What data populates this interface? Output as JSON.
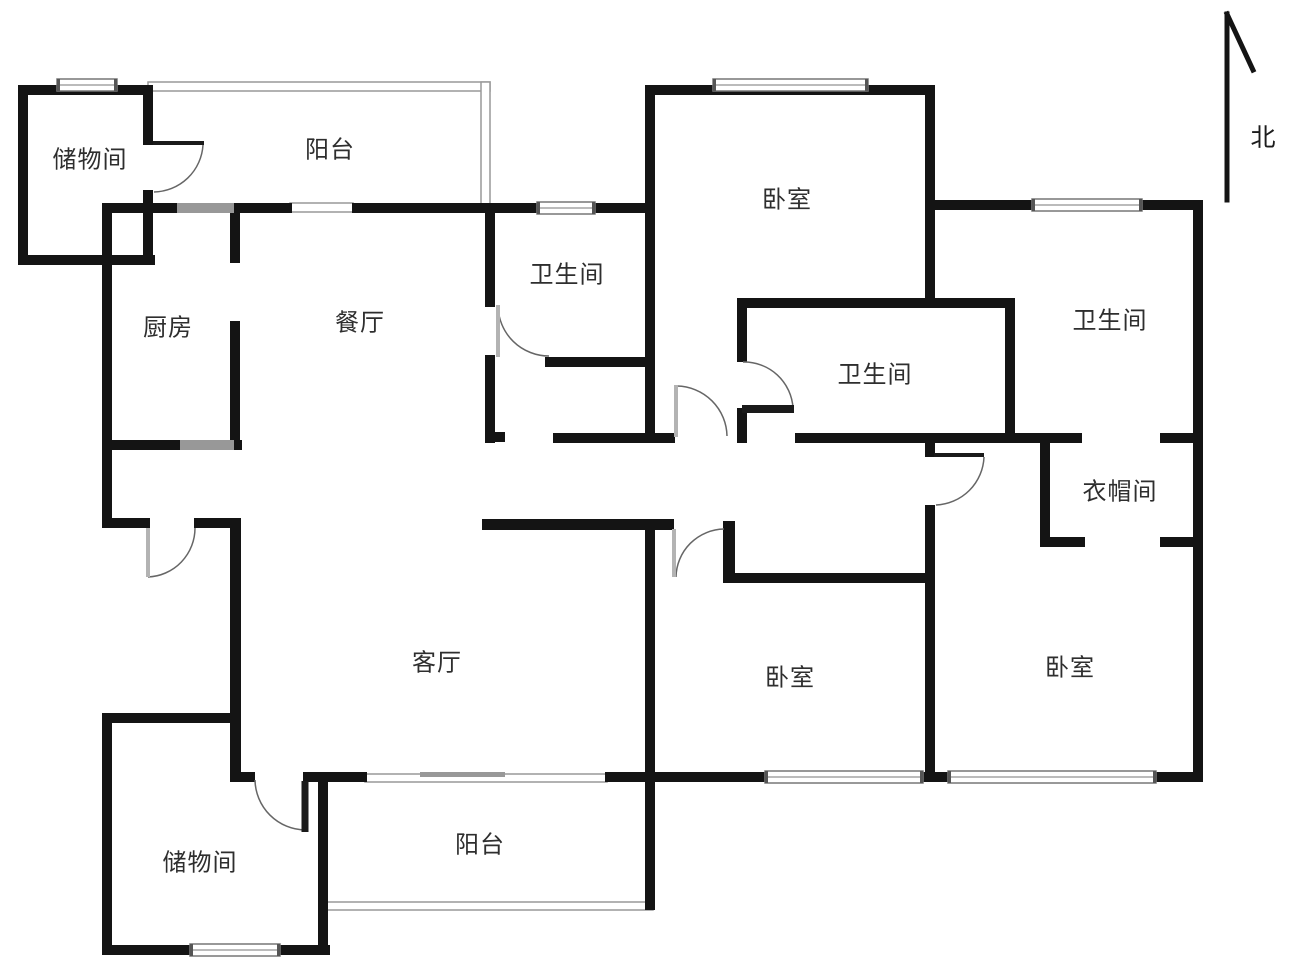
{
  "north": {
    "label": "北",
    "x": 1263,
    "y": 136,
    "lines": [
      [
        1227,
        14,
        1227,
        200
      ],
      [
        1227,
        14,
        1253,
        70
      ]
    ],
    "stroke_width": 5
  },
  "rooms": {
    "storage_top": {
      "label": "储物间",
      "x": 90,
      "y": 157
    },
    "balcony_top": {
      "label": "阳台",
      "x": 330,
      "y": 147
    },
    "bedroom_north": {
      "label": "卧室",
      "x": 787,
      "y": 197
    },
    "bath_north": {
      "label": "卫生间",
      "x": 567,
      "y": 272
    },
    "bath_east": {
      "label": "卫生间",
      "x": 1110,
      "y": 318
    },
    "kitchen": {
      "label": "厨房",
      "x": 168,
      "y": 325
    },
    "dining": {
      "label": "餐厅",
      "x": 360,
      "y": 320
    },
    "bath_mid": {
      "label": "卫生间",
      "x": 875,
      "y": 372
    },
    "closet": {
      "label": "衣帽间",
      "x": 1120,
      "y": 489
    },
    "living": {
      "label": "客厅",
      "x": 437,
      "y": 660
    },
    "bedroom_sw": {
      "label": "卧室",
      "x": 790,
      "y": 675
    },
    "bedroom_se": {
      "label": "卧室",
      "x": 1070,
      "y": 665
    },
    "storage_bottom": {
      "label": "储物间",
      "x": 200,
      "y": 860
    },
    "balcony_bottom": {
      "label": "阳台",
      "x": 480,
      "y": 842
    }
  },
  "colors": {
    "wall": "#141414",
    "window_fill": "#ffffff",
    "window_stroke": "#777777",
    "window_cap": "#555555",
    "rail_fill": "#ffffff",
    "rail_stroke": "#999999",
    "arc": "#666666",
    "leaf_gray": "#b3b3b3",
    "leaf_dark": "#1a1a1a",
    "gray_panel": "#989898"
  },
  "floorplan": {
    "rails": [
      {
        "x": 148,
        "y": 82,
        "w": 342,
        "h": 9
      },
      {
        "x": 481,
        "y": 82,
        "w": 9,
        "h": 128
      },
      {
        "x": 290,
        "y": 203,
        "w": 63,
        "h": 9
      },
      {
        "x": 365,
        "y": 774,
        "w": 242,
        "h": 8
      },
      {
        "x": 323,
        "y": 902,
        "w": 330,
        "h": 8
      }
    ],
    "walls": [
      {
        "x": 18,
        "y": 85,
        "w": 132,
        "h": 10
      },
      {
        "x": 18,
        "y": 85,
        "w": 10,
        "h": 180
      },
      {
        "x": 18,
        "y": 255,
        "w": 137,
        "h": 10
      },
      {
        "x": 143,
        "y": 85,
        "w": 10,
        "h": 60
      },
      {
        "x": 143,
        "y": 190,
        "w": 10,
        "h": 75
      },
      {
        "x": 102,
        "y": 203,
        "w": 10,
        "h": 325
      },
      {
        "x": 102,
        "y": 203,
        "w": 78,
        "h": 10
      },
      {
        "x": 232,
        "y": 203,
        "w": 60,
        "h": 10
      },
      {
        "x": 352,
        "y": 203,
        "w": 187,
        "h": 10
      },
      {
        "x": 592,
        "y": 203,
        "w": 63,
        "h": 10
      },
      {
        "x": 645,
        "y": 85,
        "w": 10,
        "h": 358
      },
      {
        "x": 645,
        "y": 85,
        "w": 290,
        "h": 10
      },
      {
        "x": 925,
        "y": 85,
        "w": 10,
        "h": 223
      },
      {
        "x": 935,
        "y": 200,
        "w": 100,
        "h": 10
      },
      {
        "x": 1138,
        "y": 200,
        "w": 65,
        "h": 10
      },
      {
        "x": 1193,
        "y": 200,
        "w": 10,
        "h": 582
      },
      {
        "x": 737,
        "y": 298,
        "w": 278,
        "h": 10
      },
      {
        "x": 737,
        "y": 298,
        "w": 10,
        "h": 64
      },
      {
        "x": 737,
        "y": 408,
        "w": 10,
        "h": 35
      },
      {
        "x": 795,
        "y": 433,
        "w": 220,
        "h": 10
      },
      {
        "x": 1005,
        "y": 298,
        "w": 10,
        "h": 145
      },
      {
        "x": 925,
        "y": 437,
        "w": 10,
        "h": 20
      },
      {
        "x": 925,
        "y": 505,
        "w": 10,
        "h": 277
      },
      {
        "x": 723,
        "y": 573,
        "w": 212,
        "h": 10
      },
      {
        "x": 723,
        "y": 521,
        "w": 12,
        "h": 62
      },
      {
        "x": 482,
        "y": 519,
        "w": 192,
        "h": 11
      },
      {
        "x": 553,
        "y": 433,
        "w": 122,
        "h": 10
      },
      {
        "x": 485,
        "y": 210,
        "w": 10,
        "h": 97
      },
      {
        "x": 485,
        "y": 355,
        "w": 10,
        "h": 88
      },
      {
        "x": 485,
        "y": 432,
        "w": 20,
        "h": 10
      },
      {
        "x": 545,
        "y": 357,
        "w": 110,
        "h": 10
      },
      {
        "x": 230,
        "y": 203,
        "w": 10,
        "h": 60
      },
      {
        "x": 230,
        "y": 321,
        "w": 10,
        "h": 129
      },
      {
        "x": 102,
        "y": 440,
        "w": 140,
        "h": 10
      },
      {
        "x": 102,
        "y": 518,
        "w": 48,
        "h": 10
      },
      {
        "x": 194,
        "y": 518,
        "w": 46,
        "h": 10
      },
      {
        "x": 230,
        "y": 518,
        "w": 11,
        "h": 264
      },
      {
        "x": 102,
        "y": 713,
        "w": 139,
        "h": 10
      },
      {
        "x": 102,
        "y": 713,
        "w": 10,
        "h": 242
      },
      {
        "x": 102,
        "y": 945,
        "w": 228,
        "h": 10
      },
      {
        "x": 318,
        "y": 772,
        "w": 10,
        "h": 183
      },
      {
        "x": 230,
        "y": 772,
        "w": 25,
        "h": 10
      },
      {
        "x": 303,
        "y": 772,
        "w": 64,
        "h": 10
      },
      {
        "x": 605,
        "y": 772,
        "w": 52,
        "h": 10
      },
      {
        "x": 645,
        "y": 521,
        "w": 10,
        "h": 389
      },
      {
        "x": 650,
        "y": 772,
        "w": 118,
        "h": 10
      },
      {
        "x": 918,
        "y": 772,
        "w": 34,
        "h": 10
      },
      {
        "x": 1150,
        "y": 772,
        "w": 53,
        "h": 10
      },
      {
        "x": 1015,
        "y": 433,
        "w": 67,
        "h": 10
      },
      {
        "x": 1160,
        "y": 433,
        "w": 43,
        "h": 10
      },
      {
        "x": 1040,
        "y": 443,
        "w": 10,
        "h": 104
      },
      {
        "x": 1040,
        "y": 537,
        "w": 45,
        "h": 10
      },
      {
        "x": 1160,
        "y": 537,
        "w": 43,
        "h": 10
      }
    ],
    "gray_panels": [
      {
        "x": 177,
        "y": 203,
        "w": 57,
        "h": 10
      },
      {
        "x": 180,
        "y": 440,
        "w": 54,
        "h": 10
      },
      {
        "x": 420,
        "y": 772,
        "w": 85,
        "h": 5
      }
    ],
    "windows": [
      {
        "x": 57,
        "y": 79,
        "w": 60,
        "h": 12
      },
      {
        "x": 713,
        "y": 79,
        "w": 155,
        "h": 12
      },
      {
        "x": 537,
        "y": 202,
        "w": 58,
        "h": 12
      },
      {
        "x": 1032,
        "y": 199,
        "w": 110,
        "h": 12
      },
      {
        "x": 765,
        "y": 771,
        "w": 158,
        "h": 12
      },
      {
        "x": 948,
        "y": 771,
        "w": 208,
        "h": 12
      },
      {
        "x": 190,
        "y": 944,
        "w": 90,
        "h": 12
      }
    ],
    "doors": [
      {
        "leaf": {
          "x1": 153,
          "y1": 143,
          "x2": 204,
          "y2": 143,
          "w": 4,
          "c": "leaf_dark"
        },
        "arc": {
          "x0": 203,
          "y0": 145,
          "x1": 154,
          "y1": 192,
          "r": 50,
          "sweep": 1
        }
      },
      {
        "leaf": {
          "x1": 148,
          "y1": 528,
          "x2": 148,
          "y2": 577,
          "w": 4,
          "c": "leaf_gray"
        },
        "arc": {
          "x0": 148,
          "y0": 577,
          "x1": 195,
          "y1": 528,
          "r": 49,
          "sweep": 0
        }
      },
      {
        "leaf": {
          "x1": 305,
          "y1": 781,
          "x2": 305,
          "y2": 832,
          "w": 7,
          "c": "leaf_dark"
        },
        "arc": {
          "x0": 255,
          "y0": 780,
          "x1": 305,
          "y1": 830,
          "r": 51,
          "sweep": 0
        }
      },
      {
        "leaf": {
          "x1": 498,
          "y1": 305,
          "x2": 498,
          "y2": 357,
          "w": 4,
          "c": "leaf_gray"
        },
        "arc": {
          "x0": 498,
          "y0": 306,
          "x1": 549,
          "y1": 356,
          "r": 51,
          "sweep": 0
        }
      },
      {
        "leaf": {
          "x1": 676,
          "y1": 385,
          "x2": 676,
          "y2": 437,
          "w": 4,
          "c": "leaf_gray"
        },
        "arc": {
          "x0": 677,
          "y0": 386,
          "x1": 727,
          "y1": 436,
          "r": 51,
          "sweep": 1
        }
      },
      {
        "leaf": {
          "x1": 742,
          "y1": 409,
          "x2": 794,
          "y2": 409,
          "w": 8,
          "c": "leaf_dark"
        },
        "arc": {
          "x0": 743,
          "y0": 362,
          "x1": 793,
          "y1": 408,
          "r": 49,
          "sweep": 1
        }
      },
      {
        "leaf": {
          "x1": 934,
          "y1": 455,
          "x2": 984,
          "y2": 455,
          "w": 4,
          "c": "leaf_dark"
        },
        "arc": {
          "x0": 984,
          "y0": 457,
          "x1": 936,
          "y1": 505,
          "r": 50,
          "sweep": 1
        }
      },
      {
        "leaf": {
          "x1": 674,
          "y1": 529,
          "x2": 674,
          "y2": 577,
          "w": 4,
          "c": "leaf_gray"
        },
        "arc": {
          "x0": 676,
          "y0": 577,
          "x1": 724,
          "y1": 529,
          "r": 49,
          "sweep": 1
        }
      }
    ]
  }
}
